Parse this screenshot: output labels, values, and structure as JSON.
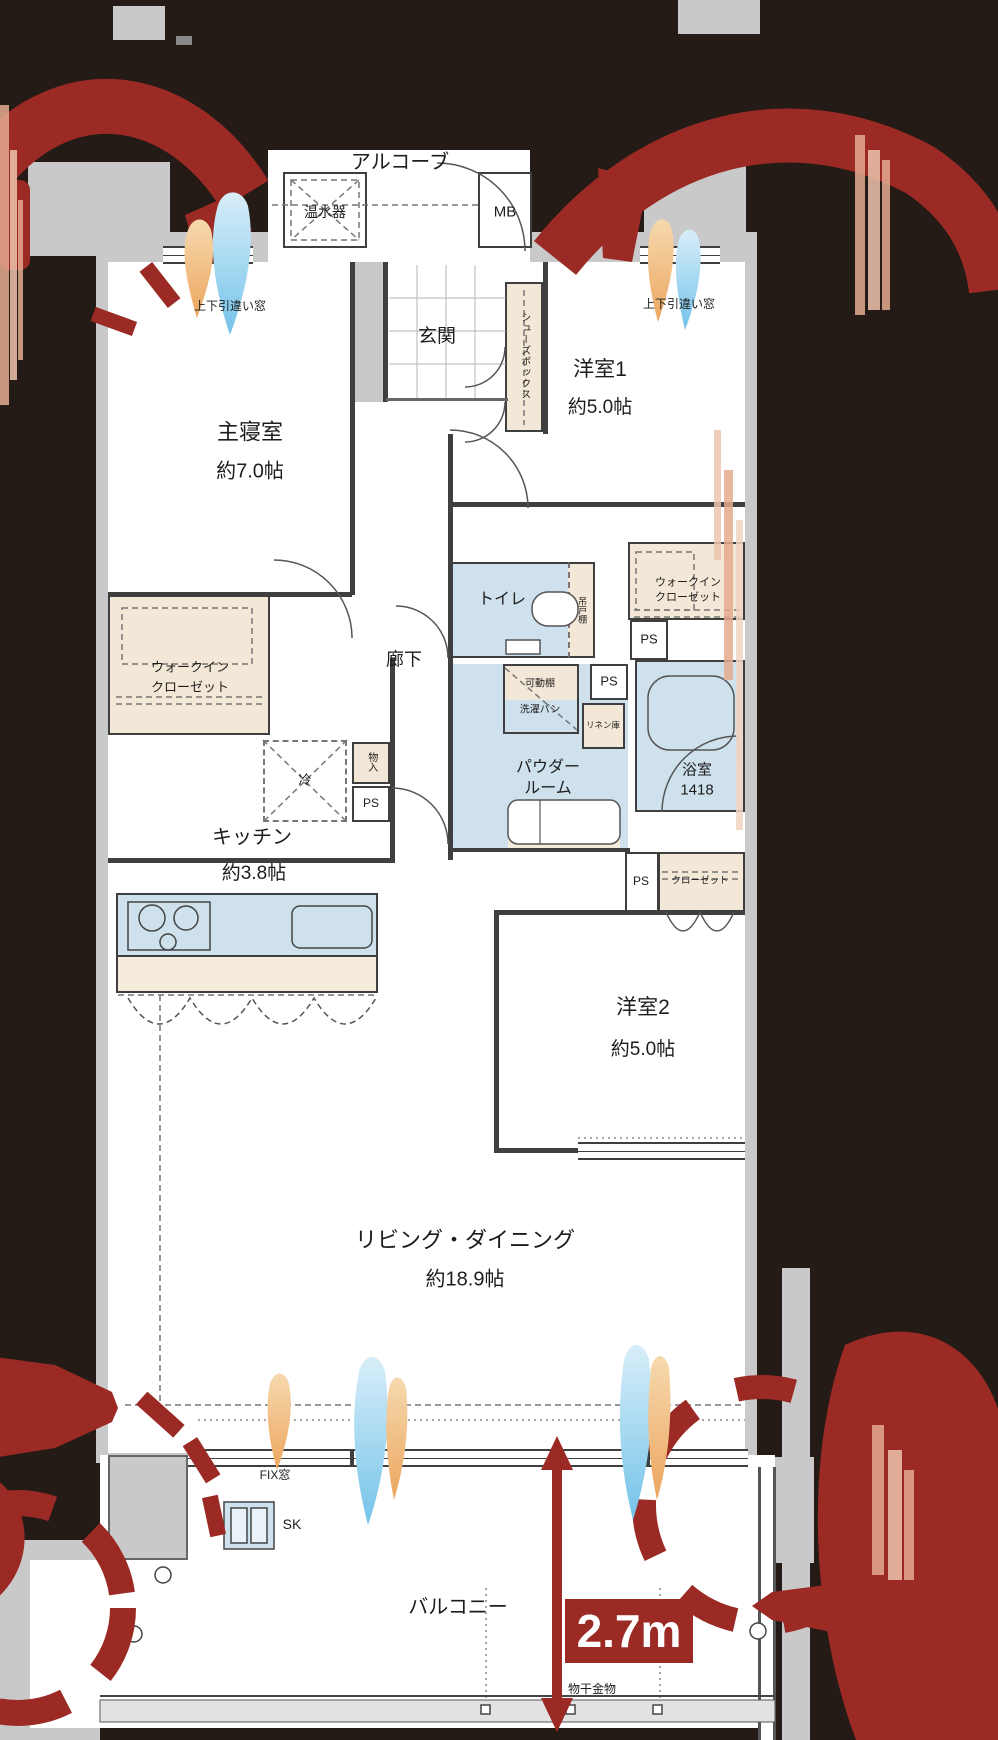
{
  "plan_labels": {
    "alcove": "アルコーブ",
    "water_heater": "温水器",
    "meter_box": "MB",
    "entrance": "玄関",
    "shoe_box": "シューズボックス",
    "window_sash_left": "上下引違い窓",
    "window_sash_right": "上下引違い窓",
    "master_name": "主寝室",
    "master_size": "約7.0帖",
    "western1_name": "洋室1",
    "western1_size": "約5.0帖",
    "western2_name": "洋室2",
    "western2_size": "約5.0帖",
    "living_name": "リビング・ダイニング",
    "living_size": "約18.9帖",
    "kitchen_name": "キッチン",
    "kitchen_size": "約3.8帖",
    "corridor": "廊下",
    "wic_line1": "ウォークイン",
    "wic_line2": "クローゼット",
    "toilet": "トイレ",
    "hanging_shelf": "吊戸棚",
    "ps": "PS",
    "movable_shelf": "可動棚",
    "laundry_pan": "洗濯パン",
    "linen": "リネン庫",
    "bath_name": "浴室",
    "bath_size": "1418",
    "powder_line1": "パウダー",
    "powder_line2": "ルーム",
    "storage": "物入",
    "fridge": "冷",
    "closet": "クローゼット",
    "fix_window": "FIX窓",
    "sk": "SK",
    "balcony": "バルコニー",
    "laundry_hardware": "物干金物",
    "ceiling_height": "2.7m"
  },
  "colors": {
    "accent_red": "#9b2a24",
    "room_blue": "#cfe1ed",
    "cabinet_beige": "#f3e8d7",
    "wall_gray": "#c9c9c9",
    "background": "#241a16",
    "wall_line": "#3f3f3f"
  }
}
